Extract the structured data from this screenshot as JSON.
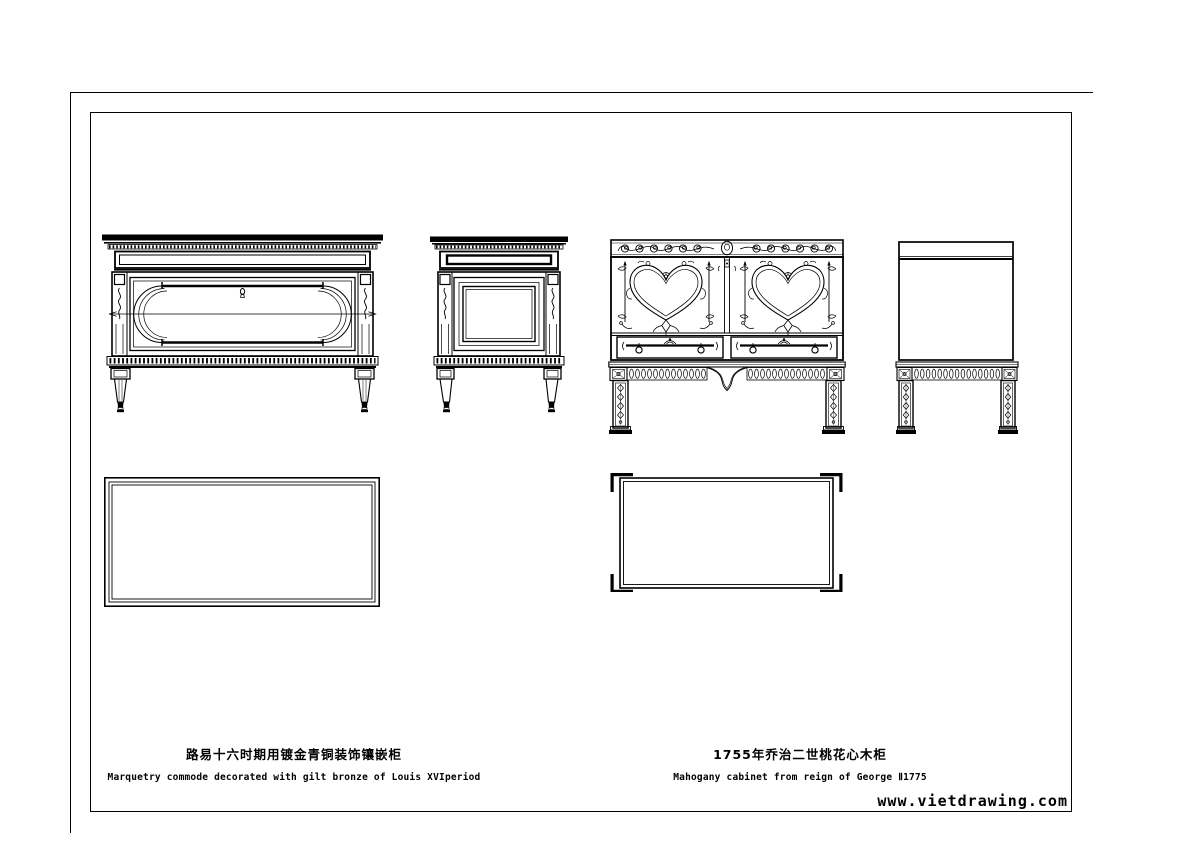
{
  "colors": {
    "background": "#ffffff",
    "ink": "#000000"
  },
  "captions": {
    "left": {
      "title_zh": "路易十六时期用镀金青铜装饰镶嵌柜",
      "subtitle_en": "Marquetry commode decorated with gilt bronze of Louis XVIperiod"
    },
    "right": {
      "title_zh": "1755年乔治二世桃花心木柜",
      "subtitle_en": "Mahogany cabinet from reign of George Ⅱ1775"
    }
  },
  "watermark": {
    "text": "www.vietdrawing.com"
  }
}
